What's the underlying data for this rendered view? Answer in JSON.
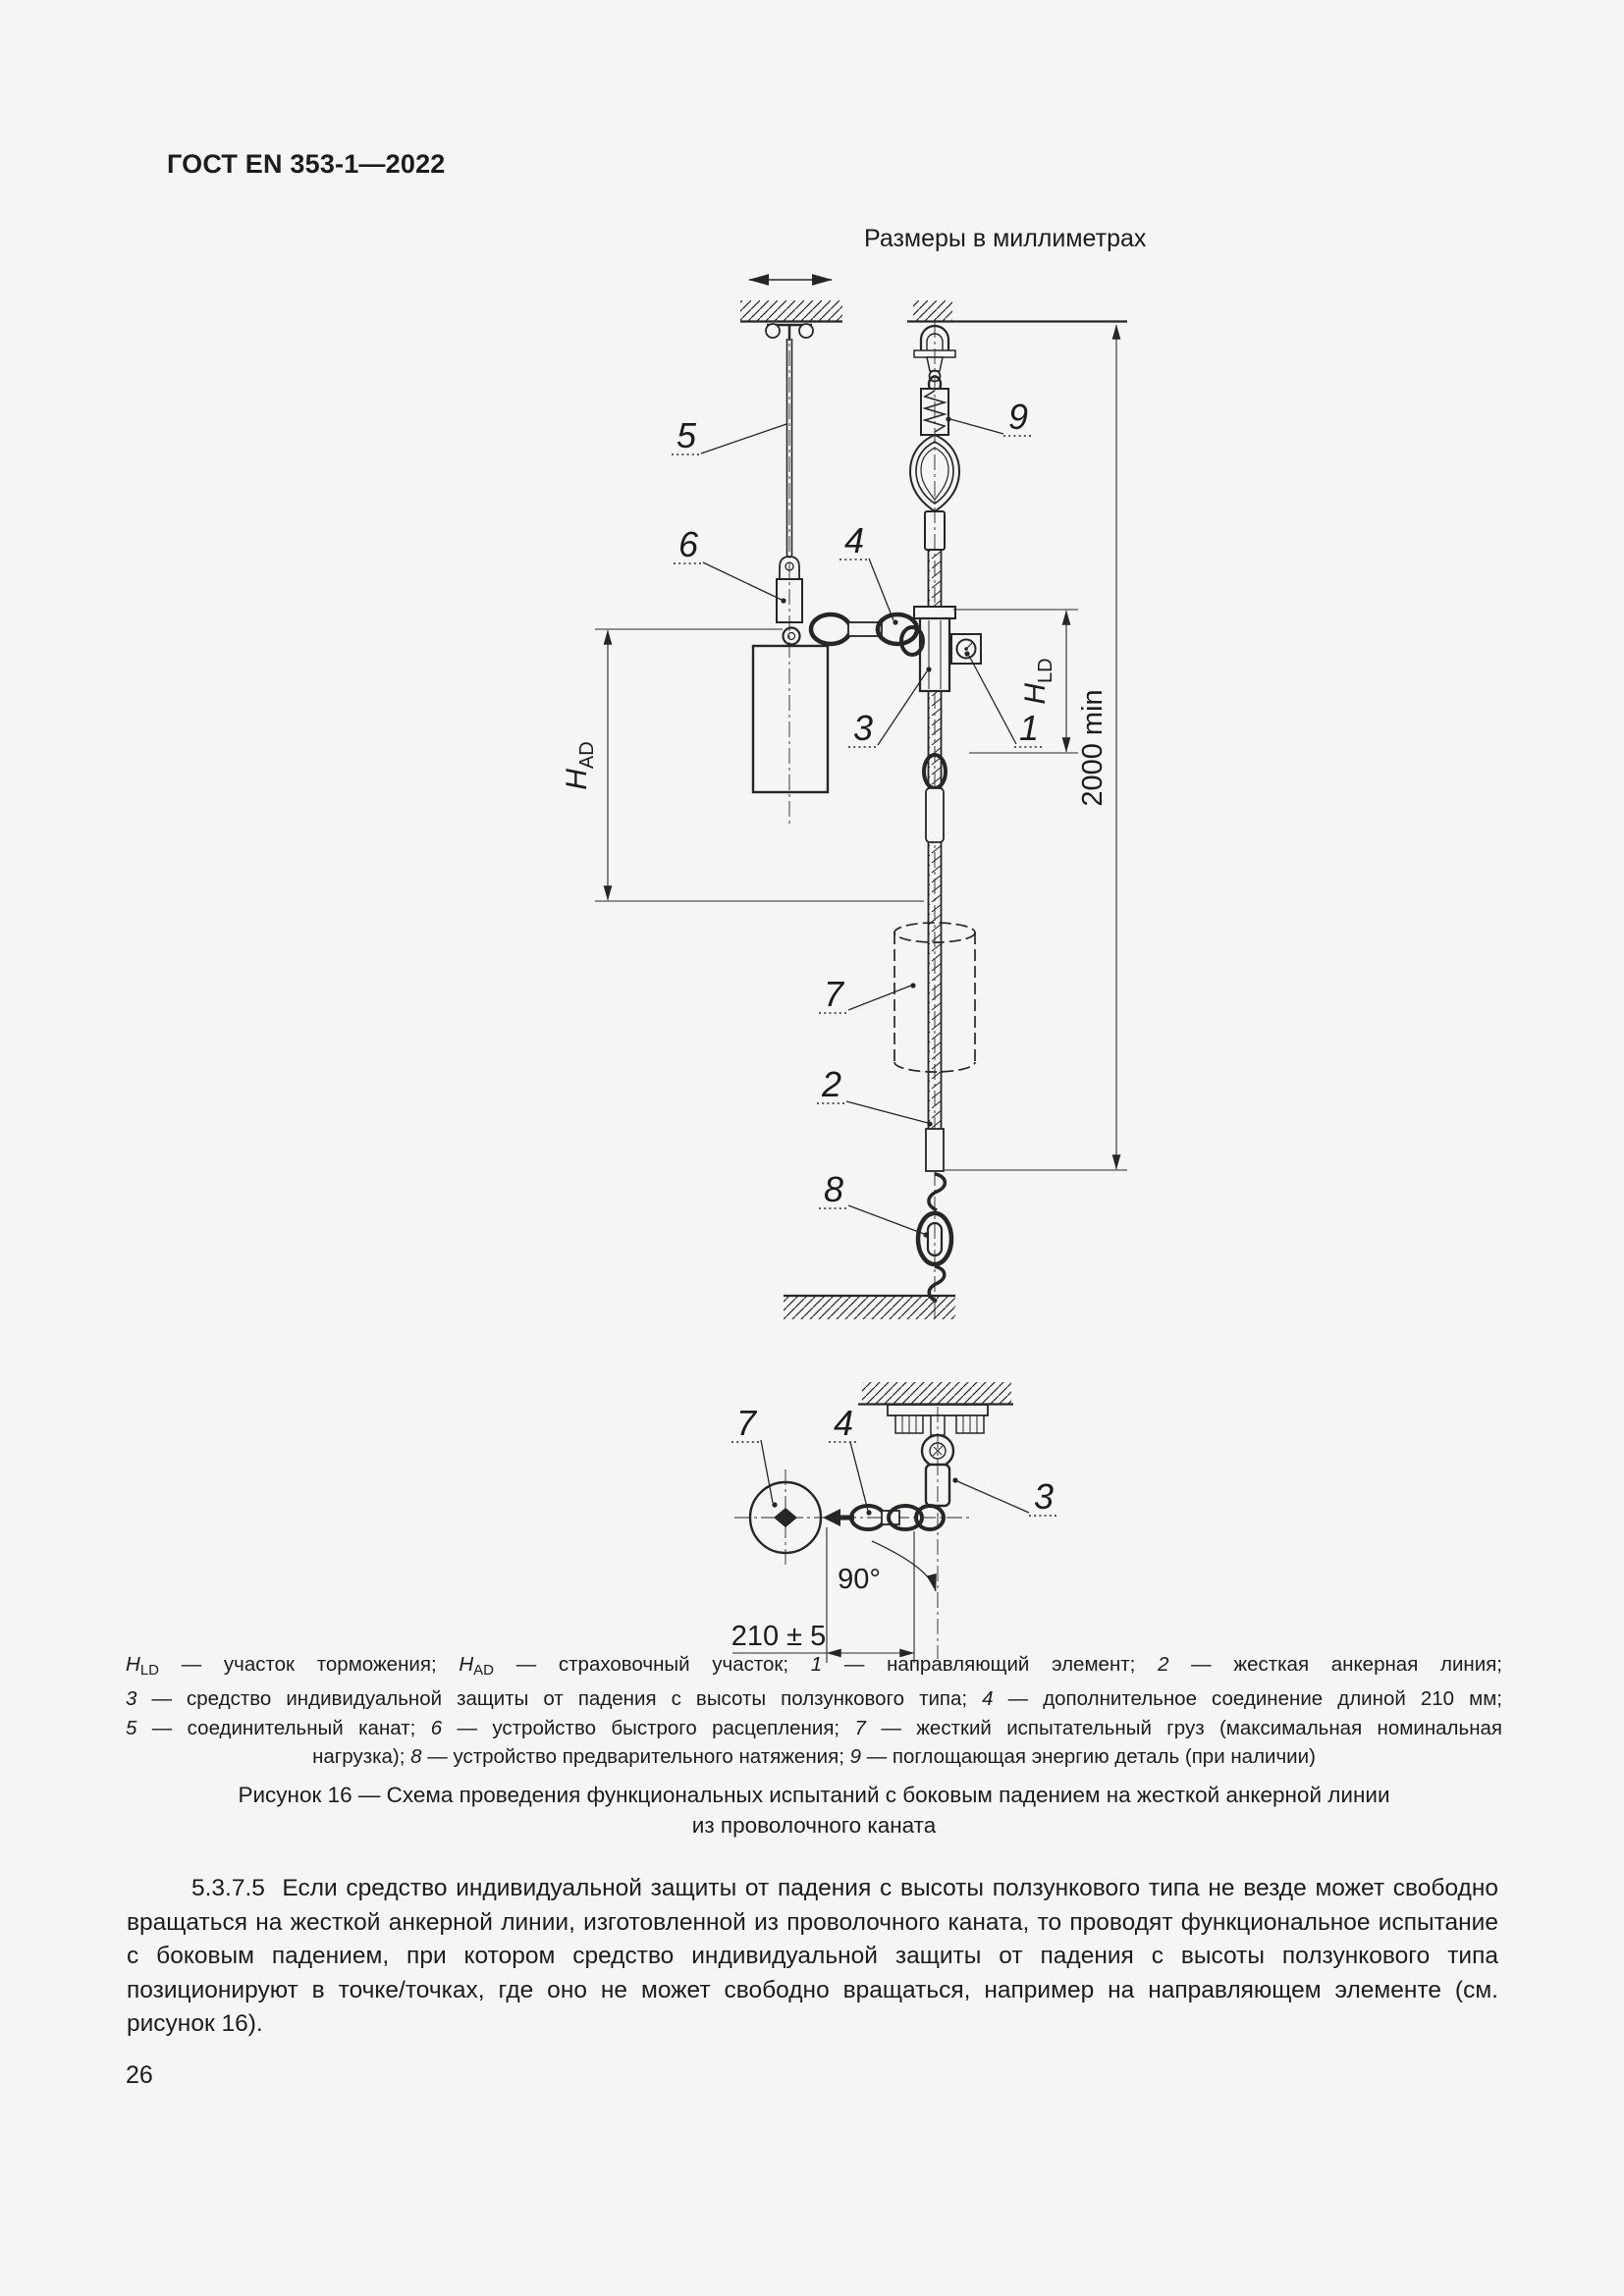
{
  "colors": {
    "ink": "#262626",
    "paper": "#f5f5f3"
  },
  "header": {
    "doc_code": "ГОСТ EN 353-1—2022"
  },
  "figure": {
    "units_note": "Размеры в миллиметрах",
    "callouts": {
      "c1": "1",
      "c2": "2",
      "c3": "3",
      "c4": "4",
      "c5": "5",
      "c6": "6",
      "c7": "7",
      "c8": "8",
      "c9": "9"
    },
    "dims": {
      "total_height": "2000 min",
      "chain_length": "210 ± 5",
      "angle": "90°",
      "h_symbol": "H",
      "ld_sub": "LD",
      "ad_sub": "AD"
    },
    "legend": {
      "line1": [
        {
          "t": "H"
        },
        {
          "t": "LD"
        },
        {
          "t": " — участок торможения; "
        },
        {
          "t": "H"
        },
        {
          "t": "AD"
        },
        {
          "t": " — страховочный участок; "
        },
        {
          "t": "1"
        },
        {
          "t": " — направляющий элемент; "
        },
        {
          "t": "2"
        },
        {
          "t": " — жесткая анкерная линия;"
        }
      ],
      "line2": [
        {
          "t": "3"
        },
        {
          "t": " — средство индивидуальной защиты от падения с высоты ползункового типа; "
        },
        {
          "t": "4"
        },
        {
          "t": " — дополнительное соединение длиной 210 мм;"
        }
      ],
      "line3": [
        {
          "t": "5"
        },
        {
          "t": " — соединительный канат; "
        },
        {
          "t": "6"
        },
        {
          "t": " — устройство быстрого расцепления; "
        },
        {
          "t": "7"
        },
        {
          "t": " — жесткий испытательный груз (максимальная номинальная"
        }
      ],
      "line4": [
        {
          "t": "нагрузка); "
        },
        {
          "t": "8"
        },
        {
          "t": " — устройство предварительного натяжения; "
        },
        {
          "t": "9"
        },
        {
          "t": " — поглощающая энергию деталь (при наличии)"
        }
      ]
    },
    "caption": [
      "Рисунок 16 — Схема проведения функциональных испытаний с боковым падением на жесткой анкерной линии",
      "из проволочного каната"
    ]
  },
  "body": {
    "paragraph": "5.3.7.5  Если средство индивидуальной защиты от падения с высоты ползункового типа не везде может свободно вращаться на жесткой анкерной линии, изготовленной из проволочного каната, то проводят функциональное испытание с боковым падением, при котором средство индивидуальной защиты от падения с высоты ползункового типа позиционируют в точке/точках, где оно не может свободно вращаться, например на направляющем элементе (см. рисунок 16)."
  },
  "footer": {
    "page_number": "26"
  }
}
